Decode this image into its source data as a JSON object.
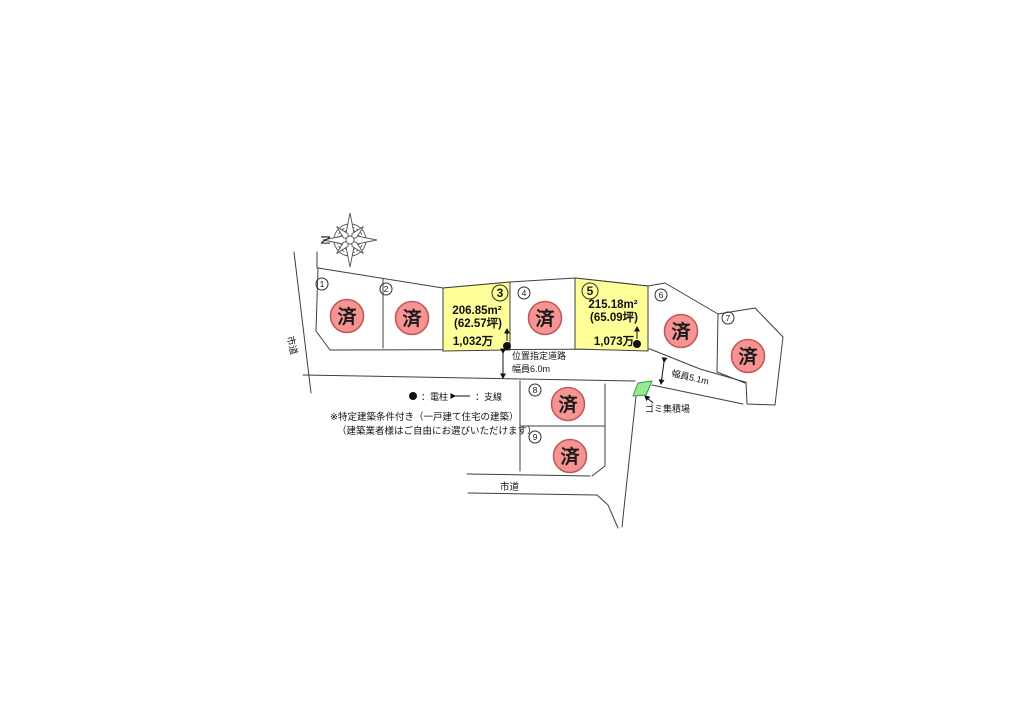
{
  "map": {
    "compass_label": "N",
    "sold_stamp": "済",
    "plots": [
      {
        "number": "1",
        "status": "済"
      },
      {
        "number": "2",
        "status": "済"
      },
      {
        "number": "3",
        "area": "206.85m²",
        "tsubo": "(62.57坪)",
        "price": "1,032万"
      },
      {
        "number": "4",
        "status": "済"
      },
      {
        "number": "5",
        "area": "215.18m²",
        "tsubo": "(65.09坪)",
        "price": "1,073万"
      },
      {
        "number": "6",
        "status": "済"
      },
      {
        "number": "7",
        "status": "済"
      },
      {
        "number": "8",
        "status": "済"
      },
      {
        "number": "9",
        "status": "済"
      }
    ],
    "roads": {
      "left_road": "市道",
      "bottom_road": "市道",
      "designated_road_name": "位置指定道路",
      "designated_road_width": "幅員6.0m",
      "side_road_width": "幅員5.1m"
    },
    "legend": {
      "pole_label": "：電柱",
      "guywire_label": "：支線"
    },
    "notes": {
      "line1": "※特定建築条件付き（一戸建て住宅の建築）",
      "line2": "（建築業者様はご自由にお選びいただけます）"
    },
    "garbage_label": "ゴミ集積場",
    "colors": {
      "available_fill": "#ffff99",
      "sold_fill": "#f59492",
      "sold_stroke": "#c05a5a",
      "garbage_fill": "#97e897",
      "line": "#3f3f3f"
    }
  }
}
